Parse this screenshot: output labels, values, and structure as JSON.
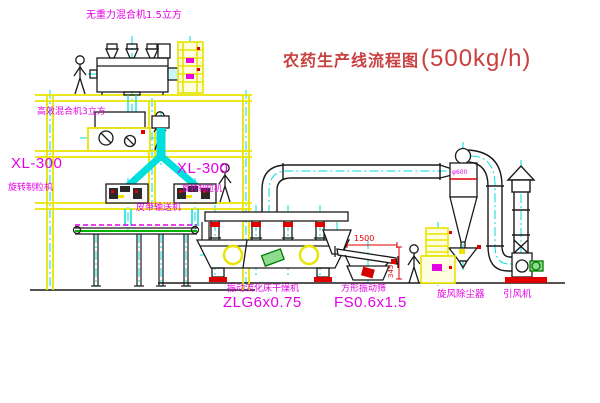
{
  "title": {
    "name": "农药生产线流程图",
    "capacity": "(500kg/h)"
  },
  "labels": {
    "gravity_mixer": "无重力混合机1.5立方",
    "high_eff_mixer": "高效混合机3立方",
    "xl300_left": "XL-300",
    "granulator_left": "旋转制粒机",
    "xl300_mid": "XL-300",
    "granulator_mid": "旋转制粒机",
    "belt_conveyor": "皮带输送机",
    "dryer_name": "振动流化床干燥机",
    "dryer_model": "ZLG6x0.75",
    "screen_name": "方形振动筛",
    "screen_model": "FS0.6x1.5",
    "cyclone": "旋风除尘器",
    "fan": "引风机",
    "cyclone_size": "φ600",
    "dim_width": "1500",
    "dim_height": "345"
  },
  "colors": {
    "structure_yellow": "#e8e400",
    "line_black": "#1a1a1a",
    "centerline_cyan": "#00dede",
    "label_magenta": "#e400e4",
    "accent_red": "#e00000",
    "title_red": "#c94040",
    "motor_green": "#8fdc8f",
    "background": "#ffffff"
  }
}
